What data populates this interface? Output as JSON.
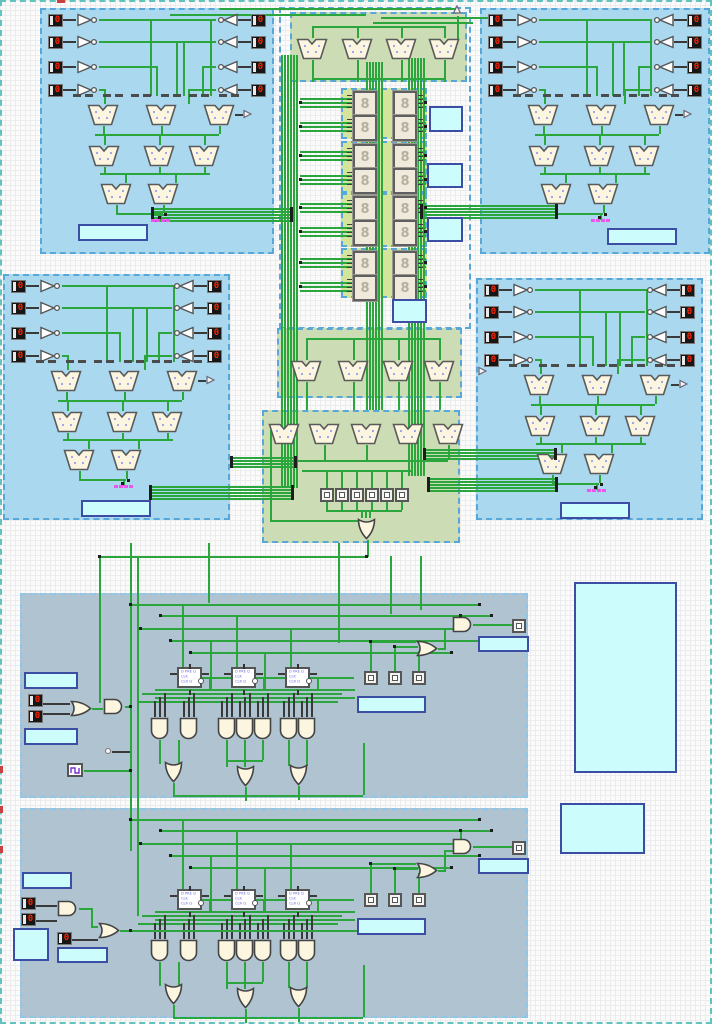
{
  "app": {
    "title": "logic-circuit-canvas",
    "description": "Logic simulator schematic: four mux-pyramid quadrant panels, central seven-segment display bank, and two sequential-logic panels with D flip-flops"
  },
  "palette": {
    "canvas_border": "#62c2bd",
    "region_blue": "#a9d8ef",
    "region_blue_border": "#57a7d8",
    "region_gray": "#b0c3d0",
    "region_gray_border": "#90c6e8",
    "region_green": "#ccdcb4",
    "region_green_bright": "#d4e59b",
    "label_box_fill": "#ccfcfc",
    "label_box_border": "#3b4ea3",
    "wire_green": "#2aa63d",
    "wire_dark": "#3a3a3a",
    "component_fill": "#fcf5e0",
    "component_stroke": "#555555",
    "pin_digit_color": "#ff2400",
    "pink_node": "#ee55ee"
  },
  "components": {
    "input_pin": {
      "value": "0"
    },
    "seven_segment_display": {
      "glyph": "8"
    },
    "flip_flop": {
      "line1": "D PRE Q",
      "line2": "CLK",
      "line3": "CLR Q"
    }
  },
  "regions": {
    "quadrant_panels": [
      {
        "name": "top-left-mux-panel",
        "left_pins": 4,
        "right_pins": 4,
        "mux_rows": [
          3,
          3,
          2
        ]
      },
      {
        "name": "top-right-mux-panel",
        "left_pins": 4,
        "right_pins": 4,
        "mux_rows": [
          3,
          3,
          2
        ]
      },
      {
        "name": "mid-left-mux-panel",
        "left_pins": 4,
        "right_pins": 4,
        "mux_rows": [
          3,
          3,
          2
        ]
      },
      {
        "name": "mid-right-mux-panel",
        "left_pins": 4,
        "right_pins": 4,
        "mux_rows": [
          3,
          3,
          2
        ]
      }
    ],
    "display_bank": {
      "groups": 4,
      "displays_per_group": 4,
      "label_boxes": 4
    },
    "top_mux_strip": {
      "mux_count": 4
    },
    "mid_mux_strip_a": {
      "mux_count": 4
    },
    "mid_mux_strip_b": {
      "mux_count": 5,
      "probe_count": 6
    },
    "sequencer_panels": [
      {
        "name": "sequencer-panel-1",
        "flip_flops": 3,
        "and_gates": 7,
        "or_gates": 3,
        "probes": 3
      },
      {
        "name": "sequencer-panel-2",
        "flip_flops": 3,
        "and_gates": 7,
        "or_gates": 3,
        "probes": 3
      }
    ],
    "side_label_boxes": 2
  },
  "labels": {
    "empty": ""
  }
}
